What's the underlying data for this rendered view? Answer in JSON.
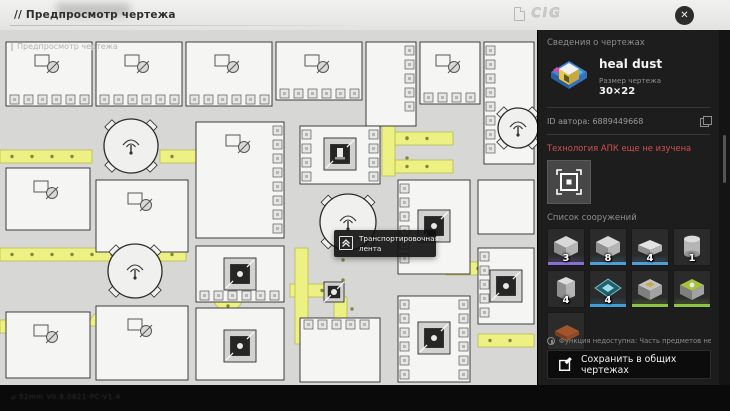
{
  "topbar": {
    "title": "// Предпросмотр чертежа",
    "logo": "CiG",
    "close_label": "✕"
  },
  "canvas": {
    "watermark": "Предпросмотр чертежа",
    "tooltip": {
      "label": "Транспортировочная лента"
    },
    "colors": {
      "belt": "#edf183",
      "belt_edge": "#b8bc50",
      "belt_dot": "#85883b",
      "building": "#f5f5f3",
      "outline": "#2d2d2d",
      "background": "#d7d7d5"
    },
    "geometry": {
      "buildings": [
        {
          "x": 6,
          "y": 12,
          "w": 86,
          "h": 64,
          "glyph": true,
          "ports": [
            "bottom"
          ]
        },
        {
          "x": 96,
          "y": 12,
          "w": 86,
          "h": 64,
          "glyph": true,
          "ports": [
            "bottom"
          ]
        },
        {
          "x": 186,
          "y": 12,
          "w": 86,
          "h": 64,
          "glyph": true,
          "ports": [
            "bottom"
          ]
        },
        {
          "x": 276,
          "y": 12,
          "w": 86,
          "h": 58,
          "glyph": true,
          "ports": [
            "bottom"
          ]
        },
        {
          "x": 366,
          "y": 12,
          "w": 50,
          "h": 84,
          "glyph": false,
          "ports": [
            "right"
          ]
        },
        {
          "x": 420,
          "y": 12,
          "w": 60,
          "h": 62,
          "glyph": true,
          "ports": [
            "bottom"
          ]
        },
        {
          "x": 484,
          "y": 12,
          "w": 50,
          "h": 122,
          "glyph": false,
          "ports": [
            "left"
          ]
        },
        {
          "x": 6,
          "y": 138,
          "w": 84,
          "h": 62,
          "glyph": true,
          "ports": []
        },
        {
          "x": 96,
          "y": 150,
          "w": 92,
          "h": 72,
          "glyph": true,
          "ports": []
        },
        {
          "x": 6,
          "y": 282,
          "w": 84,
          "h": 66,
          "glyph": true,
          "ports": []
        },
        {
          "x": 96,
          "y": 276,
          "w": 92,
          "h": 74,
          "glyph": true,
          "ports": []
        },
        {
          "x": 196,
          "y": 92,
          "w": 88,
          "h": 116,
          "glyph": true,
          "ports": [
            "right"
          ]
        },
        {
          "x": 196,
          "y": 216,
          "w": 88,
          "h": 56,
          "glyph": false,
          "ports": [
            "bottom"
          ]
        },
        {
          "x": 196,
          "y": 278,
          "w": 88,
          "h": 72,
          "glyph": false,
          "ports": []
        },
        {
          "x": 300,
          "y": 96,
          "w": 80,
          "h": 58,
          "glyph": false,
          "ports": [
            "left",
            "right"
          ]
        },
        {
          "x": 398,
          "y": 150,
          "w": 72,
          "h": 94,
          "glyph": false,
          "ports": [
            "left"
          ]
        },
        {
          "x": 398,
          "y": 266,
          "w": 72,
          "h": 86,
          "glyph": false,
          "ports": [
            "left",
            "right"
          ]
        },
        {
          "x": 478,
          "y": 150,
          "w": 56,
          "h": 54,
          "glyph": false,
          "ports": []
        },
        {
          "x": 478,
          "y": 218,
          "w": 56,
          "h": 76,
          "glyph": false,
          "ports": [
            "left"
          ]
        },
        {
          "x": 300,
          "y": 288,
          "w": 80,
          "h": 64,
          "glyph": false,
          "ports": [
            "top"
          ]
        }
      ],
      "belts": [
        {
          "x": 0,
          "y": 120,
          "w": 92,
          "h": 13
        },
        {
          "x": 160,
          "y": 120,
          "w": 36,
          "h": 13
        },
        {
          "x": 0,
          "y": 218,
          "w": 186,
          "h": 13
        },
        {
          "x": 0,
          "y": 290,
          "w": 88,
          "h": 13
        },
        {
          "x": 395,
          "y": 102,
          "w": 58,
          "h": 13
        },
        {
          "x": 395,
          "y": 130,
          "w": 58,
          "h": 13
        },
        {
          "x": 446,
          "y": 232,
          "w": 40,
          "h": 13
        },
        {
          "x": 478,
          "y": 304,
          "w": 56,
          "h": 13
        },
        {
          "x": 290,
          "y": 254,
          "w": 44,
          "h": 13
        },
        {
          "x": 382,
          "y": 96,
          "w": 13,
          "h": 50
        },
        {
          "x": 295,
          "y": 218,
          "w": 13,
          "h": 96
        },
        {
          "x": 334,
          "y": 267,
          "w": 13,
          "h": 36
        }
      ],
      "curves": [
        {
          "cx": 215,
          "cy": 192,
          "rot": 0
        },
        {
          "cx": 228,
          "cy": 266,
          "rot": 180
        },
        {
          "cx": 104,
          "cy": 296,
          "rot": 0
        }
      ],
      "fans": [
        {
          "cx": 131,
          "cy": 116,
          "r": 27
        },
        {
          "cx": 135,
          "cy": 241,
          "r": 27
        },
        {
          "cx": 348,
          "cy": 192,
          "r": 28
        },
        {
          "cx": 518,
          "cy": 98,
          "r": 20
        }
      ],
      "machines": [
        {
          "x": 340,
          "y": 124,
          "furnace": true
        },
        {
          "x": 240,
          "y": 244
        },
        {
          "x": 240,
          "y": 316
        },
        {
          "x": 434,
          "y": 196
        },
        {
          "x": 434,
          "y": 308
        },
        {
          "x": 506,
          "y": 256
        },
        {
          "x": 334,
          "y": 262,
          "small": true
        }
      ]
    }
  },
  "sidebar": {
    "section_title": "Сведения о чертежах",
    "blueprint": {
      "name": "heal dust",
      "size_label": "Размер чертежа",
      "size": "30×22"
    },
    "author_id": "ID автора: 6889449668",
    "warning": "Технология АПК еще не изучена",
    "structures_title": "Список сооружений",
    "structures": [
      {
        "count": "3",
        "accent": "#8a6fd4",
        "icon": "machine"
      },
      {
        "count": "8",
        "accent": "#4e9fd6",
        "icon": "machine"
      },
      {
        "count": "4",
        "accent": "#4e9fd6",
        "icon": "flat"
      },
      {
        "count": "1",
        "accent": "",
        "icon": "tank"
      },
      {
        "count": "4",
        "accent": "",
        "icon": "tall"
      },
      {
        "count": "4",
        "accent": "#3f9fd6",
        "icon": "diamond"
      },
      {
        "count": "",
        "accent": "#8fc43f",
        "icon": "press"
      },
      {
        "count": "",
        "accent": "#8fc43f",
        "icon": "fanbox"
      },
      {
        "count": "",
        "accent": "",
        "icon": "plate"
      }
    ],
    "footer_note": "Функция недоступна: Часть предметов неизвестна",
    "save_button": "Сохранить в общих чертежах"
  },
  "bottombar": {
    "watermark": "⊿ 52mm  V0.8.0821-PC-V1.4"
  }
}
